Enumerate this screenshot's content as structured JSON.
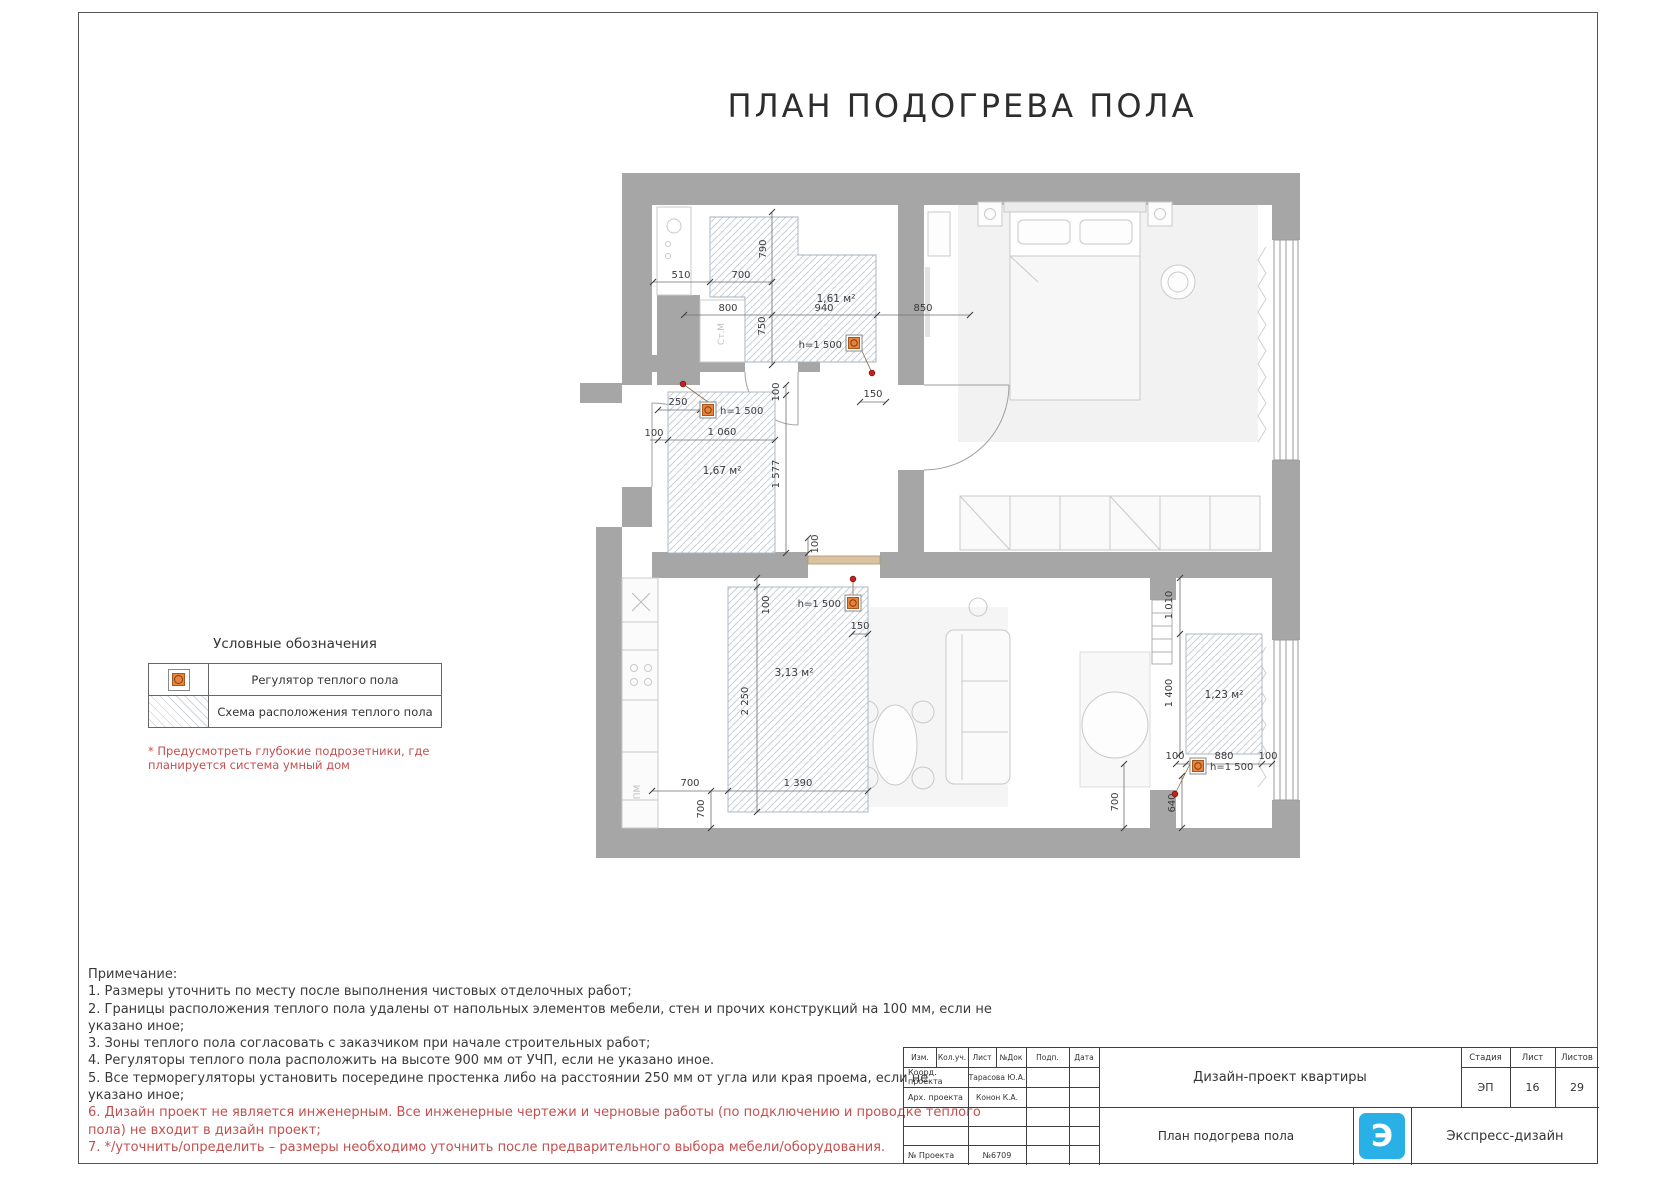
{
  "title": "ПЛАН ПОДОГРЕВА ПОЛА",
  "legend": {
    "title": "Условные обозначения",
    "items": [
      {
        "icon": "floor-heating-regulator-icon",
        "label": "Регулятор теплого пола"
      },
      {
        "icon": "floor-heating-area-swatch",
        "label": "Схема расположения теплого пола"
      }
    ],
    "footnote": "* Предусмотреть глубокие подрозетники, где планируется система умный дом"
  },
  "plan": {
    "zones": [
      {
        "area": "1,61 м²",
        "regulator_height": "h=1 500"
      },
      {
        "area": "1,67 м²",
        "regulator_height": "h=1 500"
      },
      {
        "area": "3,13 м²",
        "regulator_height": "h=1 500"
      },
      {
        "area": "1,23 м²",
        "regulator_height": "h=1 500"
      }
    ],
    "dims": [
      "510",
      "700",
      "790",
      "800",
      "940",
      "850",
      "750",
      "250",
      "100",
      "1 060",
      "1 577",
      "100",
      "150",
      "100",
      "100",
      "2 250",
      "150",
      "700",
      "1 390",
      "700",
      "1 010",
      "1 400",
      "100",
      "880",
      "100",
      "640",
      "700"
    ],
    "appliance_labels": {
      "washing_machine": "Ст.М",
      "dishwasher": "ПМ"
    }
  },
  "notes": {
    "lines": [
      "Примечание:",
      "1. Размеры уточнить по месту после выполнения чистовых отделочных работ;",
      "2. Границы расположения теплого пола удалены от напольных элементов мебели, стен и прочих конструкций на 100 мм, если не",
      "указано иное;",
      "3. Зоны теплого пола согласовать с заказчиком при начале строительных работ;",
      "4. Регуляторы теплого пола расположить на высоте 900 мм от УЧП, если не указано иное.",
      "5. Все терморегуляторы установить посередине простенка либо на расстоянии 250 мм от угла или края проема, если не",
      "указано иное;",
      "6. Дизайн проект не является инженерным. Все инженерные чертежи и черновые работы (по подключению и проводке теплого",
      "пола) не входит в дизайн проект;",
      "7.  */уточнить/определить – размеры необходимо уточнить после предварительного выбора мебели/оборудования."
    ]
  },
  "stamp": {
    "header_cols": [
      "Изм.",
      "Кол.уч.",
      "Лист",
      "№Док",
      "Подп.",
      "Дата"
    ],
    "rows": [
      {
        "label": "Коорд. проекта",
        "value": "Тарасова Ю.А."
      },
      {
        "label": "Арх. проекта",
        "value": "Конон К.А."
      }
    ],
    "project_number_label": "№ Проекта",
    "project_number": "№6709",
    "project_title": "Дизайн-проект квартиры",
    "sheet_title": "План подогрева пола",
    "stage_label": "Стадия",
    "stage": "ЭП",
    "sheet_label": "Лист",
    "sheet": "16",
    "sheets_label": "Листов",
    "sheets": "29",
    "company": "Экспресс-дизайн",
    "logo_letter": "Э"
  },
  "colors": {
    "wall_gray": "#a6a6a6",
    "hatch_blue": "#c6d0da",
    "regulator_orange": "#e8823c",
    "note_red": "#c44f4f",
    "logo_blue": "#29b0e6"
  }
}
